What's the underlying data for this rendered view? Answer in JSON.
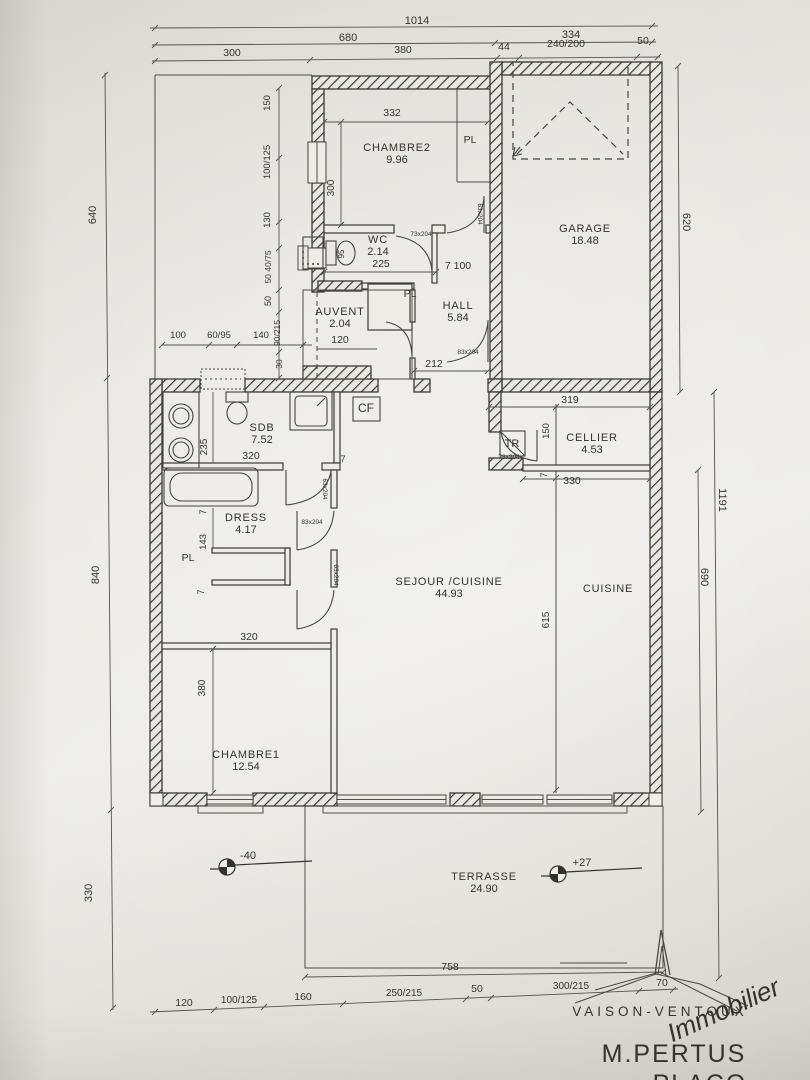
{
  "document": {
    "type": "architect-floor-plan",
    "style": "scanned-paper-photo"
  },
  "colors": {
    "ink": "#34322d",
    "paper": "#e8e6e1",
    "logo_red": "#cc3a33"
  },
  "rooms": [
    {
      "name": "CHAMBRE2",
      "area": "9.96",
      "x": 397,
      "y": 151
    },
    {
      "name": "GARAGE",
      "area": "18.48",
      "x": 585,
      "y": 232
    },
    {
      "name": "WC",
      "area": "2.14",
      "x": 378,
      "y": 243
    },
    {
      "name": "AUVENT",
      "area": "2.04",
      "x": 340,
      "y": 315
    },
    {
      "name": "HALL",
      "area": "5.84",
      "x": 458,
      "y": 309
    },
    {
      "name": "SDB",
      "area": "7.52",
      "x": 262,
      "y": 431
    },
    {
      "name": "CELLIER",
      "area": "4.53",
      "x": 592,
      "y": 441
    },
    {
      "name": "DRESS",
      "area": "4.17",
      "x": 246,
      "y": 521
    },
    {
      "name": "SEJOUR /CUISINE",
      "area": "44.93",
      "x": 449,
      "y": 585
    },
    {
      "name": "CUISINE",
      "area": "",
      "x": 608,
      "y": 592
    },
    {
      "name": "CHAMBRE1",
      "area": "12.54",
      "x": 246,
      "y": 758
    },
    {
      "name": "TERRASSE",
      "area": "24.90",
      "x": 484,
      "y": 880
    }
  ],
  "dimensions": [
    {
      "t": "1014",
      "x": 417,
      "y": 24,
      "s": 11
    },
    {
      "t": "680",
      "x": 348,
      "y": 41,
      "s": 11
    },
    {
      "t": "334",
      "x": 571,
      "y": 38,
      "s": 11
    },
    {
      "t": "300",
      "x": 232,
      "y": 56
    },
    {
      "t": "380",
      "x": 403,
      "y": 53
    },
    {
      "t": "44",
      "x": 504,
      "y": 50
    },
    {
      "t": "240/200",
      "x": 566,
      "y": 47
    },
    {
      "t": "50",
      "x": 643,
      "y": 44
    },
    {
      "t": "640",
      "x": 96,
      "y": 215,
      "r": -90,
      "s": 11
    },
    {
      "t": "840",
      "x": 99,
      "y": 575,
      "r": -90,
      "s": 11
    },
    {
      "t": "330",
      "x": 92,
      "y": 893,
      "r": -90,
      "s": 11
    },
    {
      "t": "620",
      "x": 683,
      "y": 222,
      "r": 90,
      "s": 11
    },
    {
      "t": "1191",
      "x": 719,
      "y": 500,
      "r": 90,
      "s": 11
    },
    {
      "t": "690",
      "x": 701,
      "y": 577,
      "r": 90,
      "s": 11
    },
    {
      "t": "150",
      "x": 270,
      "y": 103,
      "r": -90,
      "s": 9.5
    },
    {
      "t": "100/125",
      "x": 270,
      "y": 162,
      "r": -90,
      "s": 9.5
    },
    {
      "t": "130",
      "x": 270,
      "y": 220,
      "r": -90,
      "s": 9.5
    },
    {
      "t": "50 40/75",
      "x": 271,
      "y": 267,
      "r": -90,
      "s": 8.5
    },
    {
      "t": "50",
      "x": 271,
      "y": 301,
      "r": -90,
      "s": 9
    },
    {
      "t": "90/215",
      "x": 280,
      "y": 333,
      "r": -90,
      "s": 8.5
    },
    {
      "t": "30",
      "x": 282,
      "y": 364,
      "r": -90,
      "s": 8.5
    },
    {
      "t": "100",
      "x": 178,
      "y": 338,
      "s": 9.5
    },
    {
      "t": "60/95",
      "x": 219,
      "y": 338,
      "s": 9.5
    },
    {
      "t": "140",
      "x": 261,
      "y": 338,
      "s": 9.5
    },
    {
      "t": "332",
      "x": 392,
      "y": 116
    },
    {
      "t": "300",
      "x": 334,
      "y": 188,
      "r": -90,
      "s": 10
    },
    {
      "t": "225",
      "x": 381,
      "y": 267
    },
    {
      "t": "7 100",
      "x": 458,
      "y": 269
    },
    {
      "t": "120",
      "x": 340,
      "y": 343
    },
    {
      "t": "212",
      "x": 434,
      "y": 367
    },
    {
      "t": "235",
      "x": 207,
      "y": 447,
      "r": -90,
      "s": 10
    },
    {
      "t": "320",
      "x": 251,
      "y": 459
    },
    {
      "t": "7",
      "x": 343,
      "y": 462,
      "s": 9
    },
    {
      "t": "319",
      "x": 570,
      "y": 403
    },
    {
      "t": "150",
      "x": 549,
      "y": 431,
      "r": -90,
      "s": 9.5
    },
    {
      "t": "330",
      "x": 572,
      "y": 484
    },
    {
      "t": "7",
      "x": 547,
      "y": 475,
      "r": -90,
      "s": 9
    },
    {
      "t": "7",
      "x": 206,
      "y": 512,
      "r": -90,
      "s": 9
    },
    {
      "t": "143",
      "x": 206,
      "y": 542,
      "r": -90,
      "s": 9.5
    },
    {
      "t": "7",
      "x": 204,
      "y": 592,
      "r": -90,
      "s": 9
    },
    {
      "t": "320",
      "x": 249,
      "y": 640
    },
    {
      "t": "380",
      "x": 205,
      "y": 688,
      "r": -90,
      "s": 10
    },
    {
      "t": "615",
      "x": 549,
      "y": 620,
      "r": -90,
      "s": 10
    },
    {
      "t": "758",
      "x": 450,
      "y": 970
    },
    {
      "t": "120",
      "x": 184,
      "y": 1006
    },
    {
      "t": "100/125",
      "x": 239,
      "y": 1003,
      "s": 10
    },
    {
      "t": "160",
      "x": 303,
      "y": 1000
    },
    {
      "t": "250/215",
      "x": 404,
      "y": 996,
      "s": 10
    },
    {
      "t": "50",
      "x": 477,
      "y": 992
    },
    {
      "t": "300/215",
      "x": 571,
      "y": 989,
      "s": 10
    },
    {
      "t": "70",
      "x": 662,
      "y": 986
    }
  ],
  "door_tags": [
    {
      "t": "63x204",
      "x": 478,
      "y": 214,
      "r": 90
    },
    {
      "t": "73x204",
      "x": 421,
      "y": 236
    },
    {
      "t": "83x204",
      "x": 468,
      "y": 354
    },
    {
      "t": "63x204",
      "x": 323,
      "y": 489,
      "r": 90
    },
    {
      "t": "83x204",
      "x": 312,
      "y": 524
    },
    {
      "t": "63x204",
      "x": 334,
      "y": 575,
      "r": 90
    },
    {
      "t": "73x204",
      "x": 509,
      "y": 459
    }
  ],
  "annotations": [
    {
      "t": "PL",
      "x": 470,
      "y": 143
    },
    {
      "t": "PL",
      "x": 410,
      "y": 297
    },
    {
      "t": "PL",
      "x": 188,
      "y": 561
    },
    {
      "t": "CF",
      "x": 366,
      "y": 412,
      "s": 12
    },
    {
      "t": "TR",
      "x": 512,
      "y": 447,
      "s": 11
    },
    {
      "t": "95",
      "x": 344,
      "y": 254,
      "r": -90,
      "s": 8
    }
  ],
  "levels": [
    {
      "t": "-40",
      "x": 248,
      "y": 859
    },
    {
      "t": "+27",
      "x": 582,
      "y": 866
    }
  ],
  "logo": {
    "agency": "VAISON-VENTOUX",
    "tagline": "Immobilier",
    "client": "M.PERTUS",
    "client_line2_partial": "PLACO"
  }
}
